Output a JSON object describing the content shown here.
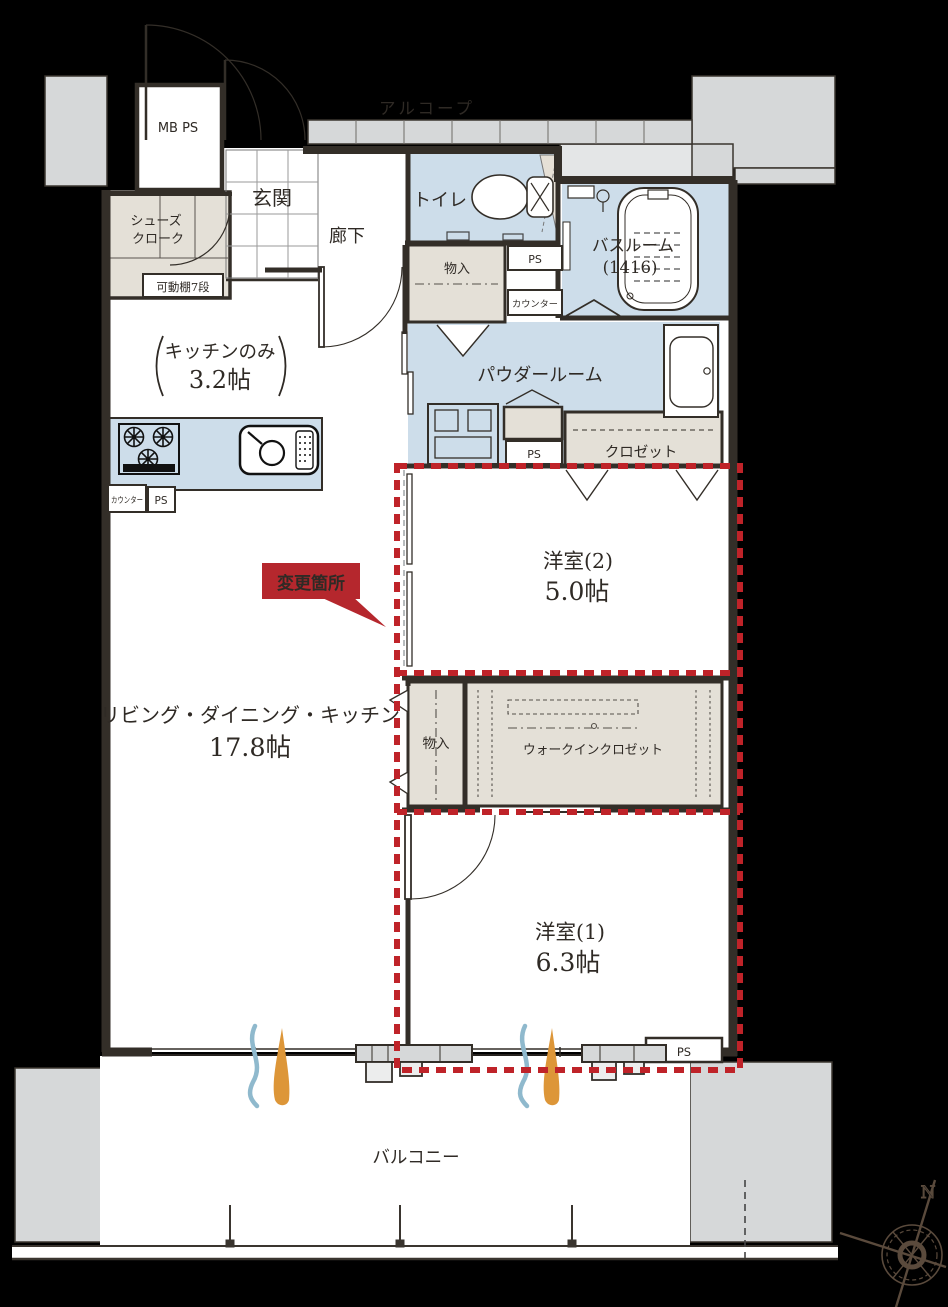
{
  "colors": {
    "background": "#000000",
    "wall_fill": "#d6d8d9",
    "wall_line": "#332e28",
    "wet_area_blue": "#cdddea",
    "closet_beige": "#e4e0d7",
    "accent_red": "#bf2329",
    "bubble_red": "#b5272d",
    "wind_blue": "#8fb9cd",
    "wind_orange": "#dd9638",
    "alcove_text": "#5a4c3e"
  },
  "outside": {
    "alcove": "アルコープ",
    "balcony": "バルコニー",
    "north": "N"
  },
  "entry": {
    "meter_box": "MB PS",
    "genkan": "玄関",
    "shoes_closet_line1": "シューズ",
    "shoes_closet_line2": "クローク",
    "movable_shelf": "可動棚7段",
    "corridor": "廊下"
  },
  "sanitary": {
    "toilet": "トイレ",
    "bathroom_line1": "バスルーム",
    "bathroom_line2": "(1416)",
    "powder_room": "パウダールーム",
    "storage": "物入",
    "ps_upper": "PS",
    "counter_upper": "カウンター",
    "ps_mid": "PS"
  },
  "kitchen": {
    "name": "キッチンのみ",
    "size": "3.2帖",
    "counter": "カウンター",
    "ps": "PS"
  },
  "living": {
    "name": "リビング・ダイニング・キッチン",
    "size": "17.8帖"
  },
  "bedroom2": {
    "name": "洋室(2)",
    "size": "5.0帖",
    "closet": "クロゼット"
  },
  "wic": {
    "storage": "物入",
    "name": "ウォークインクロゼット"
  },
  "bedroom1": {
    "name": "洋室(1)",
    "size": "6.3帖",
    "ps": "PS"
  },
  "annotation": {
    "change_area": "変更箇所"
  }
}
